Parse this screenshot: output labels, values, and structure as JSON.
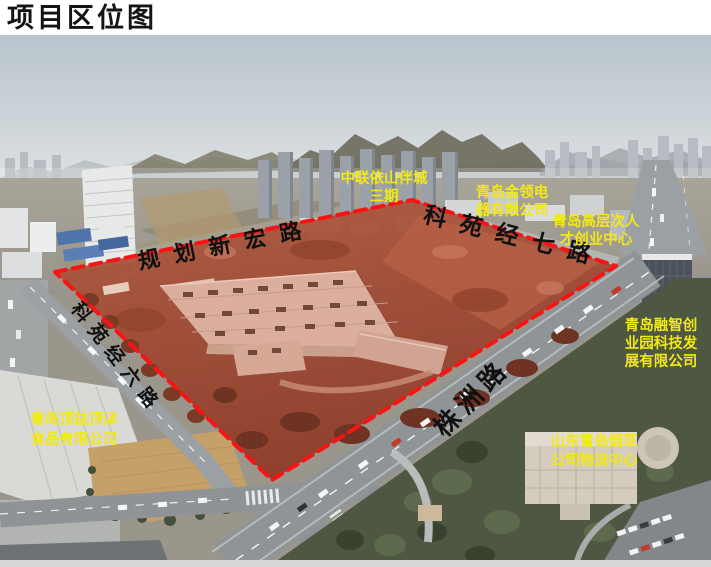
{
  "page": {
    "title": "项目区位图"
  },
  "map": {
    "road_labels": [
      {
        "id": "guihua-xinhong-lu",
        "text": "规划新宏路"
      },
      {
        "id": "keyuan-jing-qi-lu",
        "text": "科苑经七路"
      },
      {
        "id": "keyuan-jing-liu-lu",
        "text": "科苑经六路"
      },
      {
        "id": "zhuzhou-lu",
        "text": "株洲路"
      }
    ],
    "poi_labels": [
      {
        "id": "zhonglian-yishan",
        "name": "中联依山伴城三期",
        "lines": [
          "中联依山伴城",
          "三期"
        ]
      },
      {
        "id": "jinling-dianqi",
        "name": "青岛金领电器有限公司",
        "lines": [
          "青岛金领电",
          "器有限公司"
        ]
      },
      {
        "id": "gaocengci-rencai",
        "name": "青岛高层次人才创业中心",
        "lines": [
          "青岛高层次人",
          "才创业中心"
        ]
      },
      {
        "id": "rongzhi-chuangye",
        "name": "青岛融智创业园科技发展有限公司",
        "lines": [
          "青岛融智创",
          "业园科技发",
          "展有限公司"
        ]
      },
      {
        "id": "yancao-wuliu",
        "name": "山东青岛烟草公司物流中心",
        "lines": [
          "山东青岛烟草",
          "公司物流中心"
        ]
      },
      {
        "id": "dingyi-dingjin",
        "name": "青岛顶益顶津食品有限公司",
        "lines": [
          "青岛顶益顶津",
          "食品有限公司"
        ]
      }
    ],
    "colors": {
      "boundary": "#f81414",
      "site_overlay": "#a8432d",
      "poi_label": "#f2e818",
      "road_label": "#101010"
    }
  }
}
